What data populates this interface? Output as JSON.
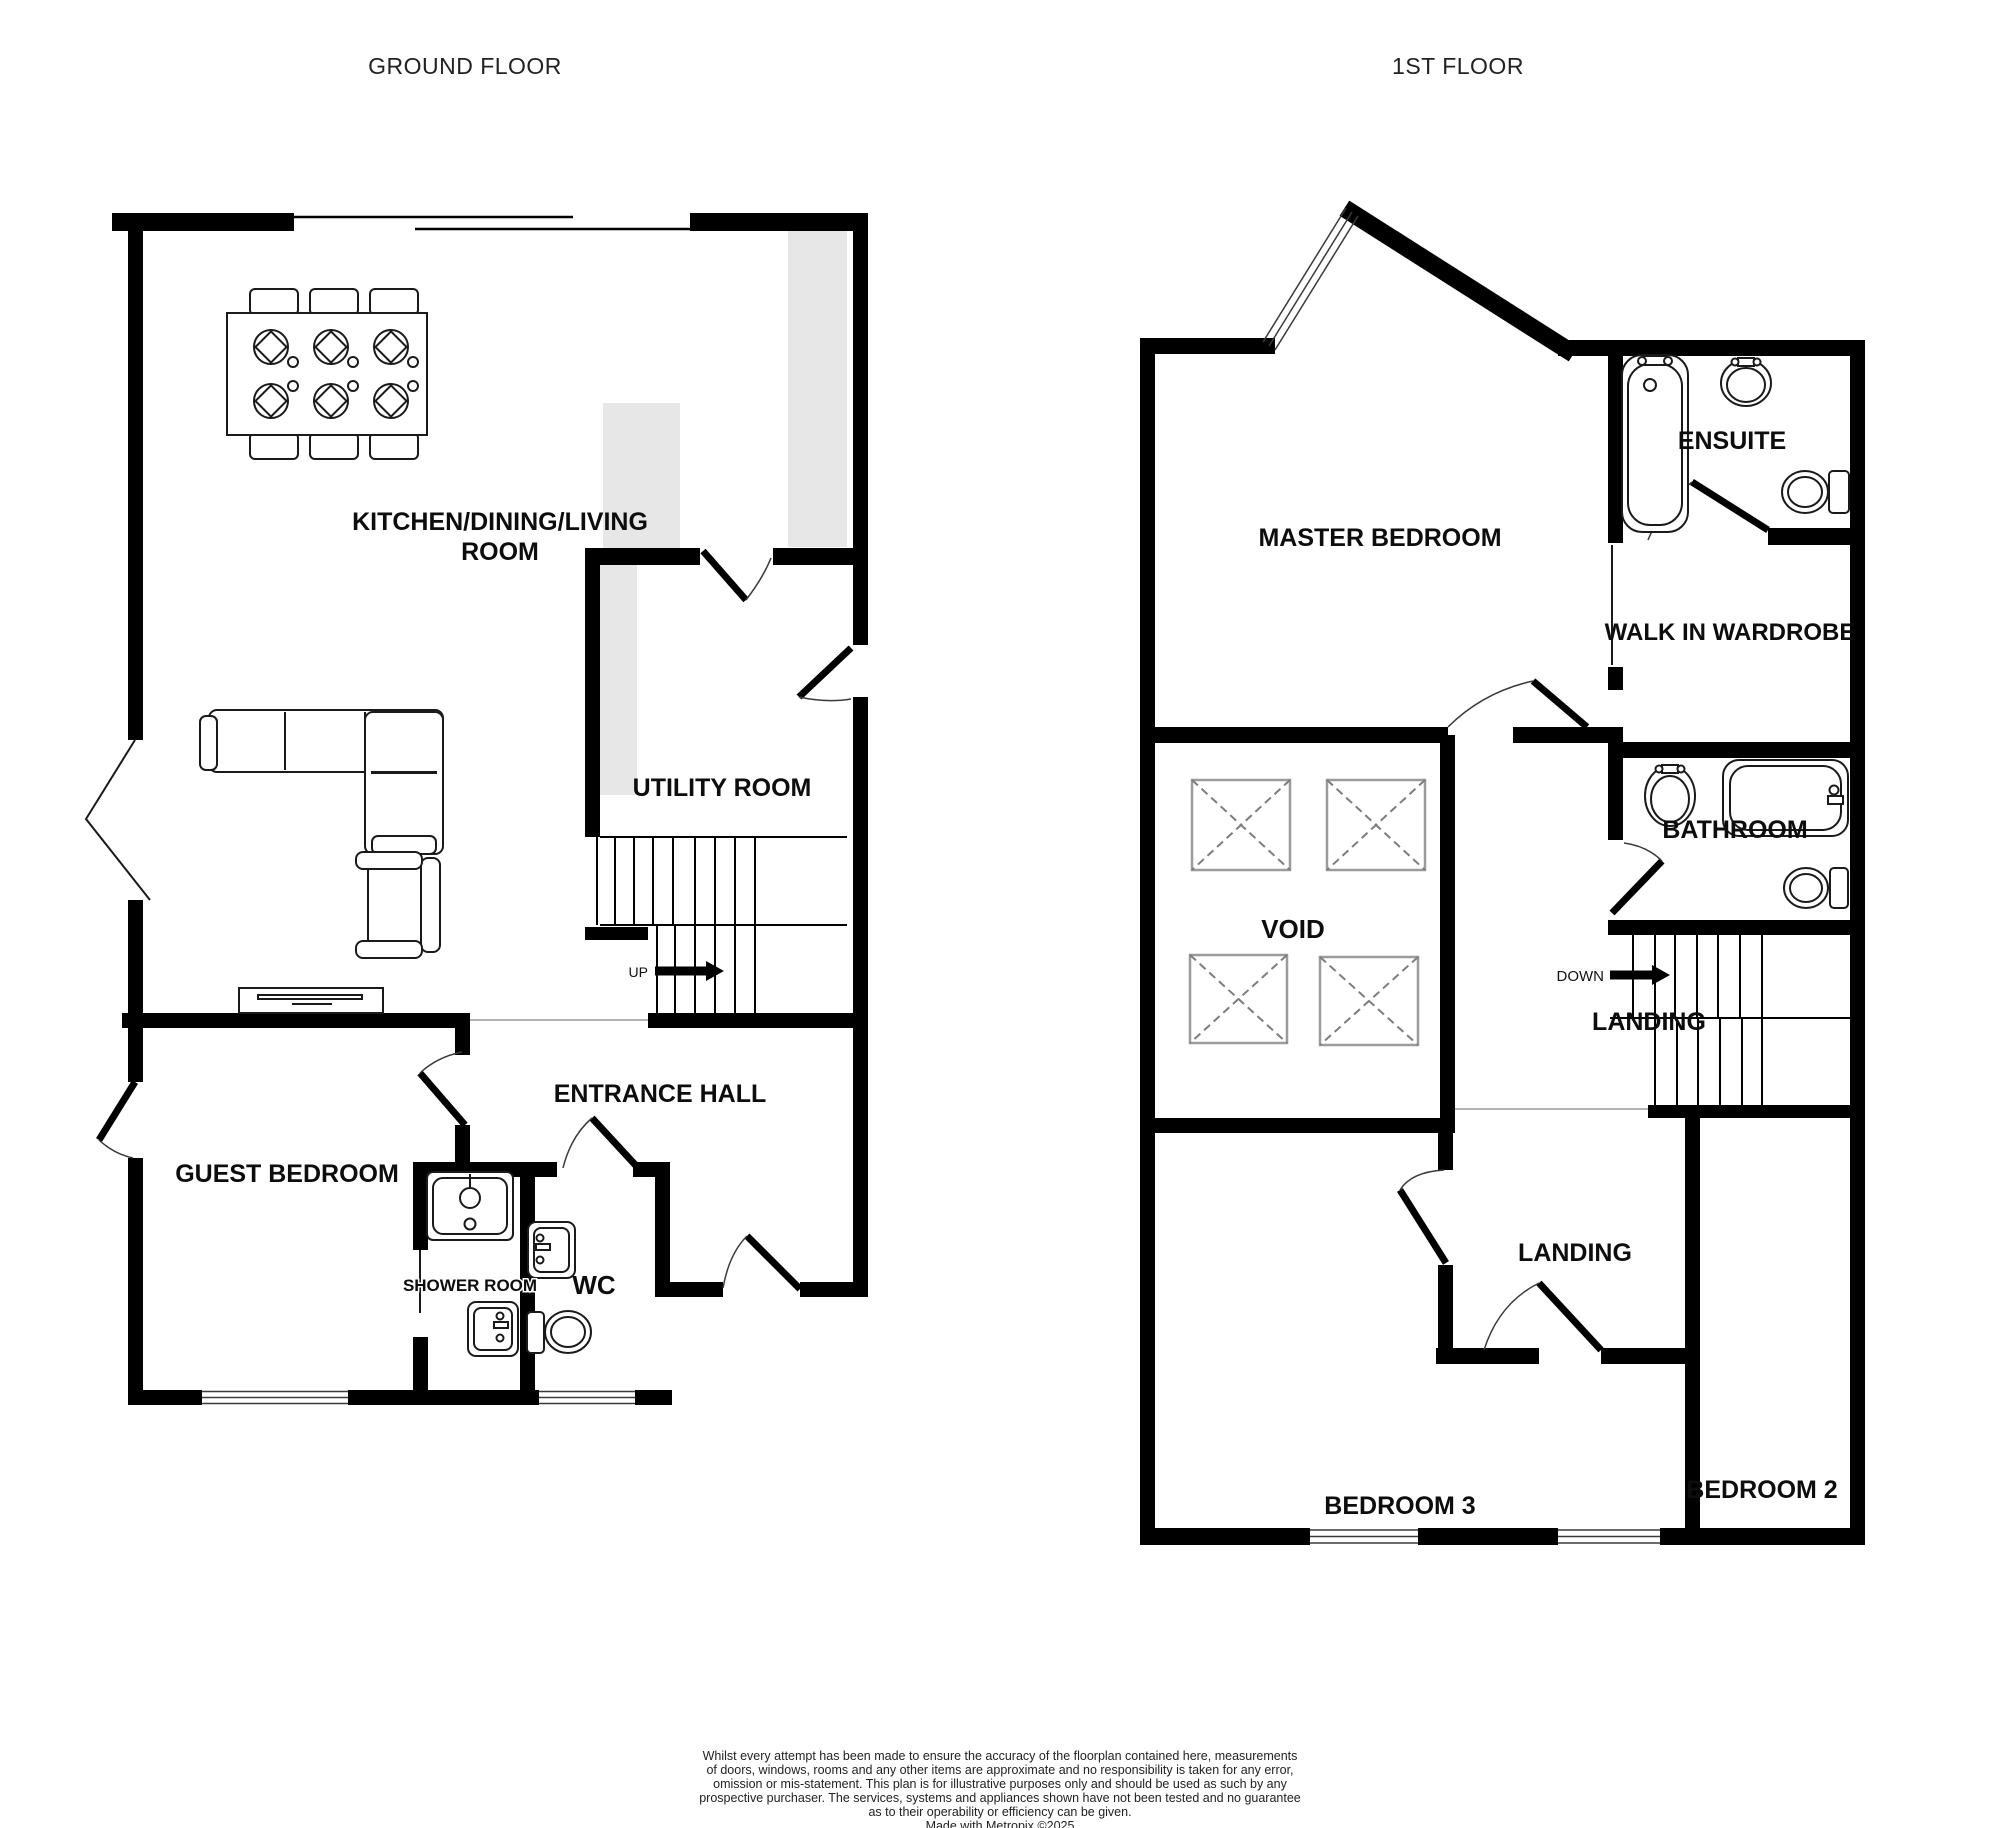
{
  "titles": {
    "ground_floor": "GROUND FLOOR",
    "first_floor": "1ST FLOOR"
  },
  "colors": {
    "wall": "#000000",
    "counter": "#e7e7e7",
    "window_line": "#3a3a3a"
  },
  "ground_floor": {
    "rooms": {
      "kitchen_line1": "KITCHEN/DINING/LIVING",
      "kitchen_line2": "ROOM",
      "utility": "UTILITY ROOM",
      "entrance_hall": "ENTRANCE HALL",
      "guest_bedroom": "GUEST BEDROOM",
      "shower_room": "SHOWER ROOM",
      "wc": "WC"
    },
    "stairs": {
      "direction_label": "UP"
    },
    "fixtures": [
      "dining-table",
      "dining-chairs",
      "corner-sofa",
      "armchair",
      "tv-unit",
      "shower-tray",
      "shower-sink",
      "wc-sink",
      "wc-toilet",
      "kitchen-counters"
    ]
  },
  "first_floor": {
    "rooms": {
      "master_bedroom": "MASTER BEDROOM",
      "ensuite": "ENSUITE",
      "walk_in_wardrobe": "WALK IN WARDROBE",
      "bathroom": "BATHROOM",
      "void": "VOID",
      "landing_upper": "LANDING",
      "landing_lower": "LANDING",
      "bedroom_3": "BEDROOM 3",
      "bedroom_2": "BEDROOM 2"
    },
    "stairs": {
      "direction_label": "DOWN"
    },
    "fixtures": [
      "ensuite-bath",
      "ensuite-sink",
      "ensuite-toilet",
      "bathroom-sink",
      "bathroom-bath",
      "bathroom-toilet",
      "void-openings"
    ]
  },
  "disclaimer": {
    "lines": [
      "Whilst every attempt has been made to ensure the accuracy of the floorplan contained here, measurements",
      "of doors, windows, rooms and any other items are approximate and no responsibility is taken for any error,",
      "omission or mis-statement. This plan is for illustrative purposes only and should be used as such by any",
      "prospective purchaser. The services, systems and appliances shown have not been tested and no guarantee",
      "as to their operability or efficiency can be given.",
      "Made with Metropix ©2025"
    ]
  }
}
